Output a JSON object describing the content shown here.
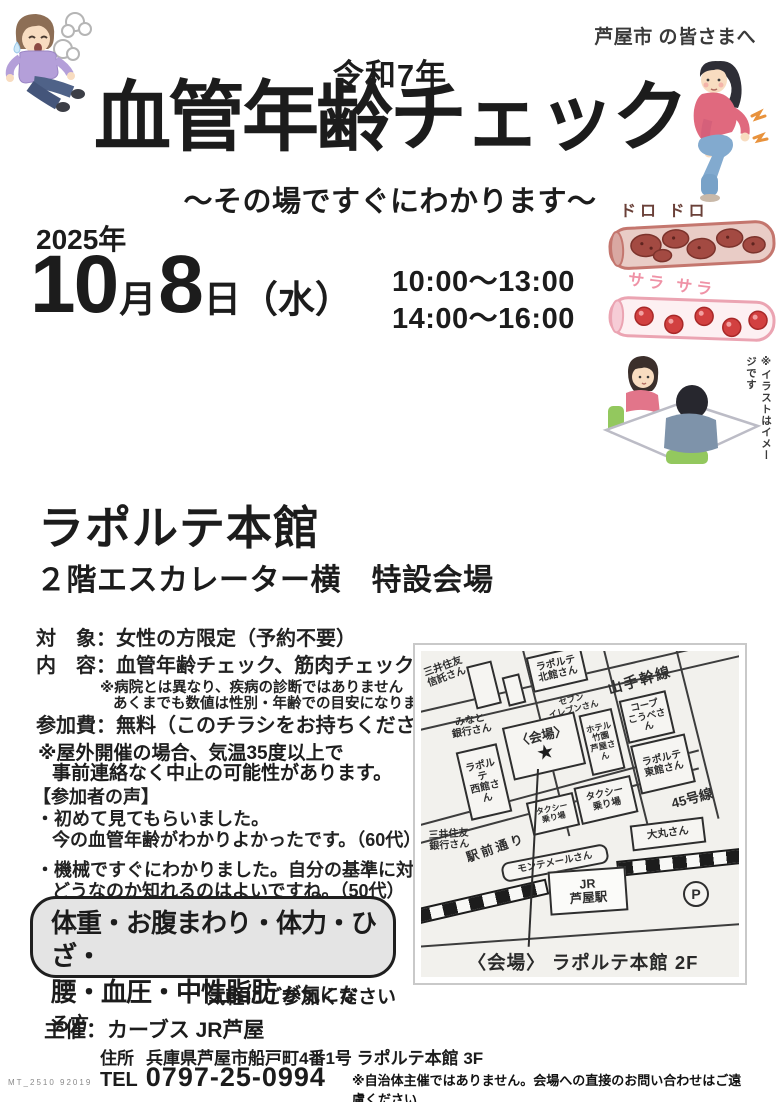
{
  "header": {
    "audience_bold": "芦屋市",
    "audience_rest": " の皆さまへ",
    "era": "令和7年",
    "title": "血管年齢チェック",
    "subtitle": "〜その場ですぐにわかります〜"
  },
  "schedule": {
    "year": "2025年",
    "month_num": "10",
    "month_unit": "月",
    "day_num": "8",
    "day_unit": "日（水）",
    "time_slot_1": "10:00〜13:00",
    "time_slot_2": "14:00〜16:00"
  },
  "vessel_illustration": {
    "dirty_label": "ドロ ドロ",
    "clean_label": "サラ サラ",
    "note_vertical": "※イラストはイメージです"
  },
  "venue": {
    "name": "ラポルテ本館",
    "detail": "２階エスカレーター横　特設会場"
  },
  "info": {
    "target_label": "対　象：",
    "target_value": "女性の方限定（予約不要）",
    "content_label": "内　容：",
    "content_value": "血管年齢チェック、筋肉チェック",
    "content_small": "など",
    "content_note1": "※病院とは異なり、疾病の診断ではありません",
    "content_note2": "あくまでも数値は性別・年齢での目安になります",
    "fee_label": "参加費：",
    "fee_value": "無料（このチラシをお持ちください）",
    "outdoor_note1": "※屋外開催の場合、気温35度以上で",
    "outdoor_note2": "事前連絡なく中止の可能性があります。"
  },
  "voices": {
    "heading": "【参加者の声】",
    "item1_line1": "・初めて見てもらいました。",
    "item1_line2": "今の血管年齢がわかりよかったです。（60代）",
    "item2_line1": "・機械ですぐにわかりました。自分の基準に対して",
    "item2_line2": "どうなのか知れるのはよいですね。（50代）"
  },
  "highlight": {
    "line1": "体重・お腹まわり・体力・ひざ・",
    "line2_bold": "腰・血圧・中性脂肪",
    "line2_suffix": "が気になる方",
    "cta": "気軽にご参加ください"
  },
  "map": {
    "labels": [
      "三井住友\n信託さん",
      "ラポルテ\n北館さん",
      "山手幹線",
      "セブン\nイレブンさん",
      "みなと\n銀行さん",
      "〈会場〉",
      "ホテル\n竹園\n芦屋さん",
      "コープ\nこうべさん",
      "ラポルテ\n東館さん",
      "ラポルテ\n西館さん",
      "タクシー\n乗り場",
      "タクシー\n乗り場",
      "45号線",
      "三井住友\n銀行さん",
      "駅前通り",
      "モンテメールさん",
      "JR\n芦屋駅",
      "大丸さん",
      "P"
    ],
    "star": "★",
    "caption": "〈会場〉 ラポルテ本館 2F"
  },
  "footer": {
    "organizer_label": "主催：",
    "organizer_value": "カーブス JR芦屋",
    "address_label": "住所",
    "address_value": "兵庫県芦屋市船戸町4番1号 ラポルテ本館 3F",
    "tel_label": "TEL",
    "tel_value": "0797-25-0994",
    "disclaimer": "※自治体主催ではありません。会場への直接のお問い合わせはご遠慮ください",
    "doc_code": "MT_2510  92019"
  }
}
